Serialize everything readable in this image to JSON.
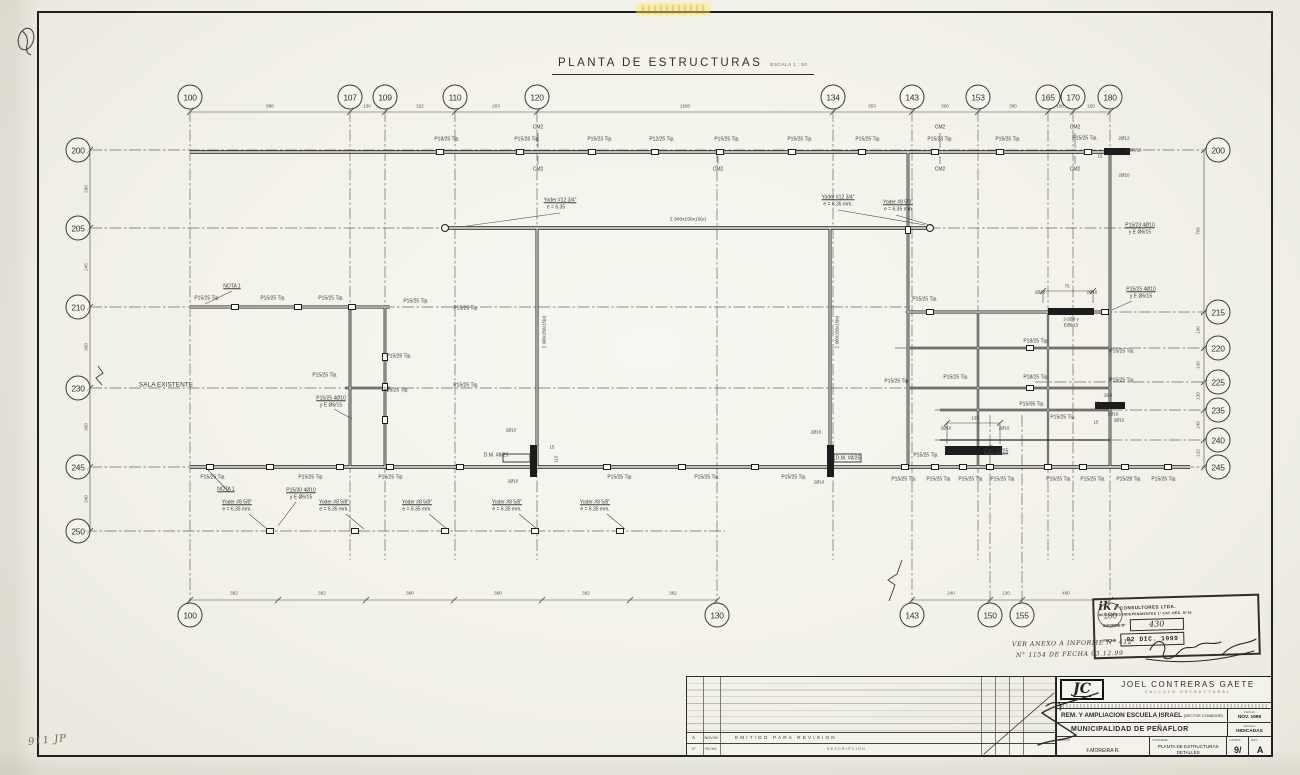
{
  "title": {
    "text": "PLANTA DE ESTRUCTURAS",
    "scale": "ESCALA 1 : 50"
  },
  "grid": {
    "top": [
      {
        "label": "100",
        "x": 190
      },
      {
        "label": "107",
        "x": 350
      },
      {
        "label": "109",
        "x": 385
      },
      {
        "label": "110",
        "x": 455
      },
      {
        "label": "120",
        "x": 537
      },
      {
        "label": "134",
        "x": 833
      },
      {
        "label": "143",
        "x": 912
      },
      {
        "label": "153",
        "x": 978
      },
      {
        "label": "165",
        "x": 1048
      },
      {
        "label": "170",
        "x": 1073
      },
      {
        "label": "180",
        "x": 1110
      }
    ],
    "top_dims": [
      {
        "text": "880",
        "x": 270
      },
      {
        "text": "130",
        "x": 367
      },
      {
        "text": "322",
        "x": 420
      },
      {
        "text": "263",
        "x": 496
      },
      {
        "text": "1500",
        "x": 685
      },
      {
        "text": "353",
        "x": 872
      },
      {
        "text": "300",
        "x": 945
      },
      {
        "text": "300",
        "x": 1013
      },
      {
        "text": "100",
        "x": 1060
      },
      {
        "text": "150",
        "x": 1091
      }
    ],
    "left": [
      {
        "label": "200",
        "y": 150
      },
      {
        "label": "205",
        "y": 228
      },
      {
        "label": "210",
        "y": 307
      },
      {
        "label": "230",
        "y": 388
      },
      {
        "label": "245",
        "y": 467
      },
      {
        "label": "250",
        "y": 531
      }
    ],
    "left_dims": [
      {
        "text": "290",
        "y": 189
      },
      {
        "text": "245",
        "y": 267
      },
      {
        "text": "300",
        "y": 347
      },
      {
        "text": "300",
        "y": 427
      },
      {
        "text": "240",
        "y": 499
      }
    ],
    "right": [
      {
        "label": "200",
        "y": 150
      },
      {
        "label": "215",
        "y": 312
      },
      {
        "label": "220",
        "y": 348
      },
      {
        "label": "225",
        "y": 382
      },
      {
        "label": "235",
        "y": 410
      },
      {
        "label": "240",
        "y": 440
      },
      {
        "label": "245",
        "y": 467
      }
    ],
    "right_dims": [
      {
        "text": "705",
        "y": 231
      },
      {
        "text": "190",
        "y": 330
      },
      {
        "text": "130",
        "y": 365
      },
      {
        "text": "130",
        "y": 396
      },
      {
        "text": "140",
        "y": 425
      },
      {
        "text": "120",
        "y": 453
      }
    ],
    "bottom": [
      {
        "label": "100",
        "x": 190
      },
      {
        "label": "130",
        "x": 717
      },
      {
        "label": "143",
        "x": 912
      },
      {
        "label": "150",
        "x": 990
      },
      {
        "label": "155",
        "x": 1022
      },
      {
        "label": "180",
        "x": 1110
      }
    ],
    "bottom_dims": [
      {
        "text": "382",
        "x": 234
      },
      {
        "text": "382",
        "x": 322
      },
      {
        "text": "380",
        "x": 410
      },
      {
        "text": "380",
        "x": 498
      },
      {
        "text": "382",
        "x": 586
      },
      {
        "text": "382",
        "x": 673
      },
      {
        "text": "240",
        "x": 951
      },
      {
        "text": "130",
        "x": 1006
      },
      {
        "text": "480",
        "x": 1066
      }
    ]
  },
  "plan_labels": [
    {
      "t": "P18/25 Tip.",
      "x": 447,
      "y": 140
    },
    {
      "t": "P15/28 Tip.",
      "x": 527,
      "y": 140
    },
    {
      "t": "P15/23 Tip.",
      "x": 600,
      "y": 140
    },
    {
      "t": "P12/25 Tip.",
      "x": 662,
      "y": 140
    },
    {
      "t": "P15/25 Tip.",
      "x": 727,
      "y": 140
    },
    {
      "t": "P15/25 Tip.",
      "x": 800,
      "y": 140
    },
    {
      "t": "P15/25 Tip.",
      "x": 868,
      "y": 140
    },
    {
      "t": "P15/23 Tip.",
      "x": 940,
      "y": 140
    },
    {
      "t": "P15/25 Tip.",
      "x": 1008,
      "y": 140
    },
    {
      "t": "P15/25 Tip.",
      "x": 1085,
      "y": 139
    },
    {
      "t": "CM2",
      "x": 538,
      "y": 128
    },
    {
      "t": "CM2",
      "x": 940,
      "y": 128
    },
    {
      "t": "CM2",
      "x": 1075,
      "y": 128
    },
    {
      "t": "CM2",
      "x": 538,
      "y": 170
    },
    {
      "t": "CM2",
      "x": 718,
      "y": 170
    },
    {
      "t": "CM2",
      "x": 940,
      "y": 170
    },
    {
      "t": "CM2",
      "x": 1075,
      "y": 170
    },
    {
      "t": "2Ø12",
      "x": 1124,
      "y": 139,
      "s": 4.5
    },
    {
      "t": "15",
      "x": 1100,
      "y": 157,
      "s": 4.2
    },
    {
      "t": "e Ø8/15",
      "x": 1134,
      "y": 151,
      "s": 4.2
    },
    {
      "t": "2Ø10",
      "x": 1124,
      "y": 176,
      "s": 4.5
    },
    {
      "t": "Yoder #12 3/4\"",
      "x": 560,
      "y": 201,
      "u": 1
    },
    {
      "t": "e = 6.35",
      "x": 556,
      "y": 208
    },
    {
      "t": "Σ 900x150x15(e)",
      "x": 688,
      "y": 220,
      "s": 4.8
    },
    {
      "t": "Yoder #12 3/4\"",
      "x": 838,
      "y": 198,
      "u": 1
    },
    {
      "t": "e = 6.35 mm.",
      "x": 838,
      "y": 205
    },
    {
      "t": "Yoder #8 5/8\"",
      "x": 898,
      "y": 203,
      "u": 1
    },
    {
      "t": "e = 6.35 mm",
      "x": 898,
      "y": 210
    },
    {
      "t": "P15/23 4Ø10",
      "x": 1140,
      "y": 226,
      "u": 1
    },
    {
      "t": "y E Ø6/15",
      "x": 1140,
      "y": 233
    },
    {
      "t": "Σ 900x150x15(e)",
      "x": 545,
      "y": 332,
      "r": -90,
      "s": 4.3
    },
    {
      "t": "Σ 900x150x15(e)",
      "x": 838,
      "y": 332,
      "r": -90,
      "s": 4.3
    },
    {
      "t": "NOTA 1",
      "x": 232,
      "y": 287,
      "u": 1
    },
    {
      "t": "P15/25 Tip.",
      "x": 207,
      "y": 299
    },
    {
      "t": "P15/25 Tip.",
      "x": 273,
      "y": 299
    },
    {
      "t": "P15/25 Tip.",
      "x": 331,
      "y": 299
    },
    {
      "t": "P15/25 Tip.",
      "x": 416,
      "y": 302
    },
    {
      "t": "P15/25 Tip.",
      "x": 466,
      "y": 309
    },
    {
      "t": "P15/25 Tip.",
      "x": 925,
      "y": 300
    },
    {
      "t": "2Ø10",
      "x": 1040,
      "y": 293,
      "s": 4.3
    },
    {
      "t": "70",
      "x": 1067,
      "y": 287,
      "s": 4.3
    },
    {
      "t": "2Ø10",
      "x": 1092,
      "y": 293,
      "s": 4.3
    },
    {
      "t": "P15/25 4Ø10",
      "x": 1141,
      "y": 290,
      "u": 1
    },
    {
      "t": "y E Ø6/15",
      "x": 1141,
      "y": 297
    },
    {
      "t": "2-2Ø8 y",
      "x": 1071,
      "y": 320,
      "s": 4.3
    },
    {
      "t": "EØ6/15",
      "x": 1071,
      "y": 326,
      "s": 4.3
    },
    {
      "t": "P18/25 Tip.",
      "x": 1036,
      "y": 342
    },
    {
      "t": "P15/25 Tip.",
      "x": 1122,
      "y": 352
    },
    {
      "t": "P15/29 Tip.",
      "x": 399,
      "y": 357
    },
    {
      "t": "P15/25 Tip.",
      "x": 325,
      "y": 376
    },
    {
      "t": "P15/25 Tip.",
      "x": 396,
      "y": 391
    },
    {
      "t": "P15/25 4Ø10",
      "x": 331,
      "y": 399,
      "u": 1
    },
    {
      "t": "y E Ø6/15",
      "x": 331,
      "y": 406
    },
    {
      "t": "P15/25 Tip.",
      "x": 466,
      "y": 386
    },
    {
      "t": "P15/25 Tip.",
      "x": 897,
      "y": 382
    },
    {
      "t": "P15/25 Tip.",
      "x": 956,
      "y": 378
    },
    {
      "t": "P18/25 Tip.",
      "x": 1036,
      "y": 378
    },
    {
      "t": "P15/25 Tip.",
      "x": 1122,
      "y": 381
    },
    {
      "t": "P15/05 Tip.",
      "x": 1032,
      "y": 405
    },
    {
      "t": "2Ø8",
      "x": 1108,
      "y": 396,
      "s": 4.3
    },
    {
      "t": "15",
      "x": 1097,
      "y": 404,
      "s": 4.2
    },
    {
      "t": "2Ø10",
      "x": 1113,
      "y": 415,
      "s": 4.3
    },
    {
      "t": "135",
      "x": 975,
      "y": 419,
      "s": 4.3
    },
    {
      "t": "2Ø10",
      "x": 946,
      "y": 429,
      "s": 4.3
    },
    {
      "t": "2Ø10",
      "x": 1004,
      "y": 429,
      "s": 4.3
    },
    {
      "t": "D.M. #8/25",
      "x": 996,
      "y": 452,
      "u": 1
    },
    {
      "t": "P15/25 Tip.",
      "x": 1063,
      "y": 418
    },
    {
      "t": "15",
      "x": 1096,
      "y": 423,
      "s": 4.2
    },
    {
      "t": "2Ø10",
      "x": 1119,
      "y": 421,
      "s": 4.3
    },
    {
      "t": "2Ø10",
      "x": 511,
      "y": 431,
      "s": 4.3
    },
    {
      "t": "D.M. #8/25",
      "x": 496,
      "y": 456
    },
    {
      "t": "15",
      "x": 552,
      "y": 448,
      "s": 4.2
    },
    {
      "t": "115",
      "x": 557,
      "y": 459,
      "r": -90,
      "s": 4.2
    },
    {
      "t": "2Ø10",
      "x": 513,
      "y": 482,
      "s": 4.3
    },
    {
      "t": "2Ø10",
      "x": 816,
      "y": 433,
      "s": 4.3
    },
    {
      "t": "D.M. #8/25",
      "x": 848,
      "y": 459
    },
    {
      "t": "2Ø10",
      "x": 819,
      "y": 483,
      "s": 4.3
    },
    {
      "t": "P15/25 Tip.",
      "x": 926,
      "y": 456
    },
    {
      "t": "P15/25 Tip.",
      "x": 213,
      "y": 478
    },
    {
      "t": "P15/25 Tip.",
      "x": 311,
      "y": 478
    },
    {
      "t": "P15/25 Tip.",
      "x": 391,
      "y": 478
    },
    {
      "t": "P15/25 Tip.",
      "x": 620,
      "y": 478
    },
    {
      "t": "P15/25 Tip.",
      "x": 707,
      "y": 478
    },
    {
      "t": "P15/25 Tip.",
      "x": 794,
      "y": 478
    },
    {
      "t": "P15/25 Tip.",
      "x": 904,
      "y": 480
    },
    {
      "t": "P15/25 Tip.",
      "x": 939,
      "y": 480
    },
    {
      "t": "P15/25 Tip.",
      "x": 971,
      "y": 480
    },
    {
      "t": "P15/25 Tip.",
      "x": 1003,
      "y": 480
    },
    {
      "t": "P15/25 Tip.",
      "x": 1059,
      "y": 480
    },
    {
      "t": "P15/25 Tip.",
      "x": 1093,
      "y": 480
    },
    {
      "t": "P15/28 Tip.",
      "x": 1129,
      "y": 480
    },
    {
      "t": "P15/25 Tip.",
      "x": 1164,
      "y": 480
    },
    {
      "t": "NOTA 1",
      "x": 226,
      "y": 490,
      "u": 1
    },
    {
      "t": "P15/30 4Ø10",
      "x": 301,
      "y": 491,
      "u": 1
    },
    {
      "t": "y E Ø6/15",
      "x": 301,
      "y": 498
    },
    {
      "t": "Yoder #8 5/8\"",
      "x": 237,
      "y": 503,
      "u": 1
    },
    {
      "t": "e = 6.35 mm.",
      "x": 237,
      "y": 510
    },
    {
      "t": "Yoder #8 5/8\"",
      "x": 334,
      "y": 503,
      "u": 1
    },
    {
      "t": "e = 6.35 mm.",
      "x": 334,
      "y": 510
    },
    {
      "t": "Yoder #8 5/8\"",
      "x": 417,
      "y": 503,
      "u": 1
    },
    {
      "t": "e = 6.35 mm.",
      "x": 417,
      "y": 510
    },
    {
      "t": "Yoder #8 5/8\"",
      "x": 507,
      "y": 503,
      "u": 1
    },
    {
      "t": "e = 6.35 mm.",
      "x": 507,
      "y": 510
    },
    {
      "t": "Yoder #8 5/8\"",
      "x": 595,
      "y": 503,
      "u": 1
    },
    {
      "t": "e = 6.35 mm.",
      "x": 595,
      "y": 510
    },
    {
      "t": "SALA EXISTENTE",
      "x": 166,
      "y": 385,
      "s": 6.5
    }
  ],
  "revision": {
    "row_rev": "A",
    "row_date": "NOV.99",
    "row_desc": "EMITIDO PARA REVISION",
    "header_no": "N°",
    "header_fecha": "FECHA",
    "header_desc": "DESCRIPCION"
  },
  "titleblock": {
    "jc_logo": "JC",
    "firm_name": "JOEL CONTRERAS GAETE",
    "firm_sub": "CALCULO ESTRUCTURAL",
    "project_line1": "REM. Y AMPLIACION ESCUELA ISRAEL",
    "project_line1_paren": "(SECTOR COMEDOR)",
    "project_line2": "MUNICIPALIDAD DE PEÑAFLOR",
    "fecha_label": "FECHA",
    "fecha_value": "NOV. 1999",
    "escala_label": "ESCALA",
    "escala_value": "INDICADAS",
    "dibujo_label": "DIBUJO",
    "dibujo_value": "F.MOREIRA R.",
    "contiene_label": "CONTIENE",
    "contiene_value1": "PLANTA DE ESTRUCTURAS",
    "contiene_value2": "DETALLES",
    "lamina_label": "LAMINA",
    "lamina_value": "9/",
    "rev_label": "REV.",
    "rev_value": "A"
  },
  "stamp": {
    "logo": "ik",
    "slashes": "//",
    "firm": "CONSULTORES LTDA.",
    "firm2": "REVISORES INDEPENDIENTES 1ª CAT. REG. N°16",
    "informe_label": "INFORME N°",
    "informe_value": "430",
    "fecha_label": "FECHA",
    "fecha_value": "02 DIC. 1999"
  },
  "handwriting": {
    "note1": "VER ANEXO A INFORME N° 412",
    "note2": "N° 1154 DE FECHA 03.12.99",
    "corner": "911 JP"
  }
}
